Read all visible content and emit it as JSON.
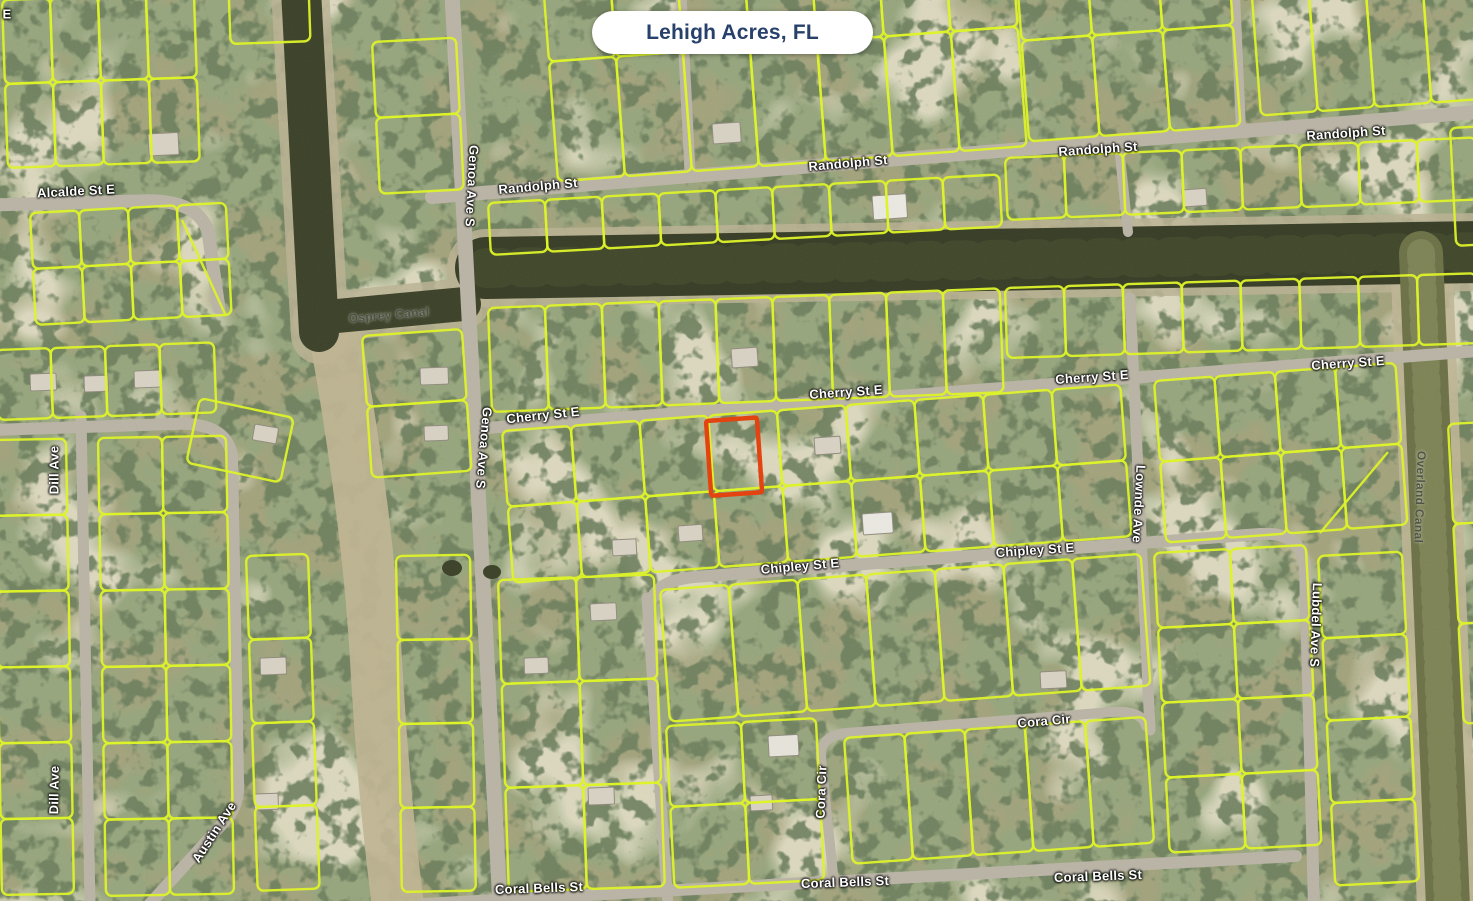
{
  "location_pill": {
    "label": "Lehigh Acres, FL"
  },
  "map": {
    "parcel_line_color": "#dcf226",
    "highlighted_parcel": {
      "stroke": "#e2400e"
    },
    "street_labels": [
      {
        "text": "E",
        "x": 7,
        "y": 14,
        "rot": 0
      },
      {
        "text": "Alcalde St E",
        "x": 76,
        "y": 191,
        "rot": -3
      },
      {
        "text": "Randolph St",
        "x": 538,
        "y": 186,
        "rot": -5
      },
      {
        "text": "Randolph St",
        "x": 848,
        "y": 163,
        "rot": -5
      },
      {
        "text": "Randolph St",
        "x": 1098,
        "y": 149,
        "rot": -4
      },
      {
        "text": "Randolph St",
        "x": 1346,
        "y": 133,
        "rot": -4
      },
      {
        "text": "Genoa Ave S",
        "x": 472,
        "y": 186,
        "rot": 93
      },
      {
        "text": "Genoa Ave S",
        "x": 484,
        "y": 448,
        "rot": 95
      },
      {
        "text": "Cherry St E",
        "x": 543,
        "y": 415,
        "rot": -6
      },
      {
        "text": "Cherry St E",
        "x": 846,
        "y": 392,
        "rot": -4
      },
      {
        "text": "Cherry St E",
        "x": 1092,
        "y": 377,
        "rot": -4
      },
      {
        "text": "Cherry St E",
        "x": 1348,
        "y": 363,
        "rot": -4
      },
      {
        "text": "Dill Ave",
        "x": 54,
        "y": 470,
        "rot": -90
      },
      {
        "text": "Dill Ave",
        "x": 54,
        "y": 790,
        "rot": -89
      },
      {
        "text": "Chipley St E",
        "x": 800,
        "y": 566,
        "rot": -5
      },
      {
        "text": "Chipley St E",
        "x": 1035,
        "y": 550,
        "rot": -4
      },
      {
        "text": "Lownde Ave",
        "x": 1139,
        "y": 504,
        "rot": 93
      },
      {
        "text": "Cora Cir",
        "x": 1044,
        "y": 721,
        "rot": -5
      },
      {
        "text": "Cora Cir",
        "x": 821,
        "y": 792,
        "rot": -88
      },
      {
        "text": "Austin Ave",
        "x": 214,
        "y": 832,
        "rot": -57
      },
      {
        "text": "Coral Bells St",
        "x": 539,
        "y": 888,
        "rot": -2
      },
      {
        "text": "Coral Bells St",
        "x": 845,
        "y": 882,
        "rot": -2
      },
      {
        "text": "Coral Bells St",
        "x": 1098,
        "y": 876,
        "rot": -2
      },
      {
        "text": "Lubdel Ave S",
        "x": 1316,
        "y": 625,
        "rot": 92
      }
    ],
    "canal_labels": [
      {
        "text": "Osprey Canal",
        "x": 389,
        "y": 315,
        "rot": -5
      },
      {
        "text": "Overland Canal",
        "x": 1420,
        "y": 497,
        "rot": 92
      }
    ]
  }
}
